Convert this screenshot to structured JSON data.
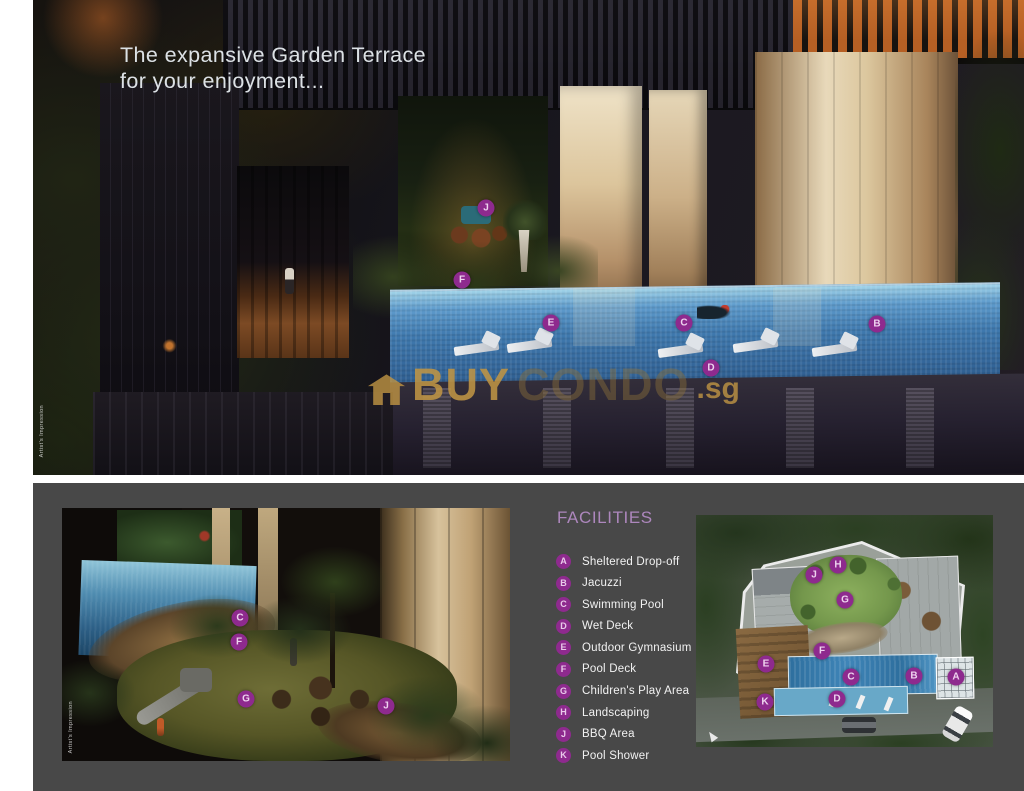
{
  "page": {
    "headline_line1": "The expansive Garden Terrace",
    "headline_line2": "for your enjoyment...",
    "artist_caption": "Artist's Impression"
  },
  "watermark": {
    "icon": "house-icon",
    "text_bold": "BUY",
    "text_light": "CONDO",
    "suffix": ".sg"
  },
  "colors": {
    "marker_purple": "#8e2a8e",
    "facilities_title_lilac": "#ad87bd",
    "panel_gray": "#484848",
    "watermark_gold": "#c09544",
    "pool_blue": "#3f79ae"
  },
  "facilities": {
    "title": "FACILITIES",
    "items": [
      {
        "key": "A",
        "label": "Sheltered Drop-off"
      },
      {
        "key": "B",
        "label": "Jacuzzi"
      },
      {
        "key": "C",
        "label": "Swimming Pool"
      },
      {
        "key": "D",
        "label": "Wet Deck"
      },
      {
        "key": "E",
        "label": "Outdoor Gymnasium"
      },
      {
        "key": "F",
        "label": "Pool Deck"
      },
      {
        "key": "G",
        "label": "Children's Play Area"
      },
      {
        "key": "H",
        "label": "Landscaping"
      },
      {
        "key": "J",
        "label": "BBQ Area"
      },
      {
        "key": "K",
        "label": "Pool Shower"
      }
    ]
  },
  "markers": {
    "terrace": [
      {
        "key": "J",
        "x": 486,
        "y": 208
      },
      {
        "key": "F",
        "x": 462,
        "y": 280
      },
      {
        "key": "E",
        "x": 551,
        "y": 323
      },
      {
        "key": "C",
        "x": 684,
        "y": 323
      },
      {
        "key": "B",
        "x": 877,
        "y": 324
      },
      {
        "key": "D",
        "x": 711,
        "y": 368
      }
    ],
    "courtyard": [
      {
        "key": "C",
        "x": 240,
        "y": 618
      },
      {
        "key": "F",
        "x": 239,
        "y": 642
      },
      {
        "key": "G",
        "x": 246,
        "y": 699
      },
      {
        "key": "J",
        "x": 386,
        "y": 706
      }
    ],
    "siteplan": [
      {
        "key": "H",
        "x": 838,
        "y": 565
      },
      {
        "key": "J",
        "x": 814,
        "y": 575
      },
      {
        "key": "G",
        "x": 845,
        "y": 600
      },
      {
        "key": "F",
        "x": 822,
        "y": 651
      },
      {
        "key": "E",
        "x": 766,
        "y": 664
      },
      {
        "key": "C",
        "x": 851,
        "y": 677
      },
      {
        "key": "B",
        "x": 914,
        "y": 676
      },
      {
        "key": "A",
        "x": 956,
        "y": 677
      },
      {
        "key": "K",
        "x": 765,
        "y": 702
      },
      {
        "key": "D",
        "x": 837,
        "y": 699
      }
    ]
  }
}
